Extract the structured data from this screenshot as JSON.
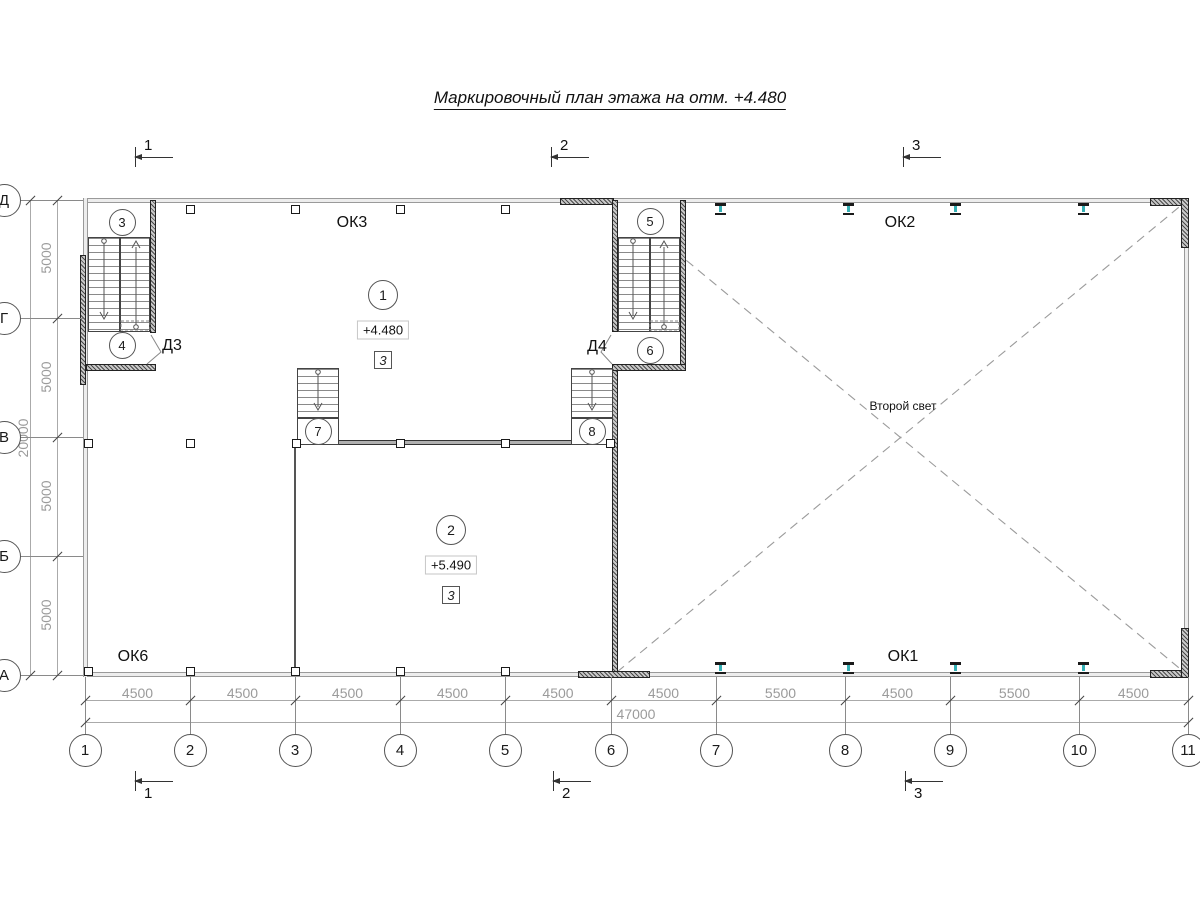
{
  "title": "Маркировочный план этажа на отм. +4.480",
  "void_label": "Второй свет",
  "section_markers": {
    "top": [
      {
        "label": "1",
        "x": 135
      },
      {
        "label": "2",
        "x": 551
      },
      {
        "label": "3",
        "x": 903
      }
    ],
    "bottom": [
      {
        "label": "1",
        "x": 135
      },
      {
        "label": "2",
        "x": 553
      },
      {
        "label": "3",
        "x": 905
      }
    ]
  },
  "axes": {
    "bottom": [
      {
        "label": "1",
        "x": 85
      },
      {
        "label": "2",
        "x": 190
      },
      {
        "label": "3",
        "x": 295
      },
      {
        "label": "4",
        "x": 400
      },
      {
        "label": "5",
        "x": 505
      },
      {
        "label": "6",
        "x": 611
      },
      {
        "label": "7",
        "x": 716
      },
      {
        "label": "8",
        "x": 845
      },
      {
        "label": "9",
        "x": 950
      },
      {
        "label": "10",
        "x": 1079
      },
      {
        "label": "11",
        "x": 1188
      }
    ],
    "left": [
      {
        "label": "Д",
        "y": 200
      },
      {
        "label": "Г",
        "y": 318
      },
      {
        "label": "В",
        "y": 437
      },
      {
        "label": "Б",
        "y": 556
      },
      {
        "label": "А",
        "y": 675
      }
    ]
  },
  "dimensions": {
    "bottom_segments": [
      "4500",
      "4500",
      "4500",
      "4500",
      "4500",
      "4500",
      "5500",
      "4500",
      "5500",
      "4500"
    ],
    "bottom_total": "47000",
    "left_segments": [
      "5000",
      "5000",
      "5000",
      "5000"
    ],
    "left_total": "20000"
  },
  "marks": {
    "windows": [
      {
        "label": "ОК3",
        "x": 352,
        "y": 223
      },
      {
        "label": "ОК2",
        "x": 900,
        "y": 223
      },
      {
        "label": "ОК6",
        "x": 133,
        "y": 657
      },
      {
        "label": "ОК1",
        "x": 903,
        "y": 657
      }
    ],
    "doors": [
      {
        "label": "Д3",
        "x": 172,
        "y": 346
      },
      {
        "label": "Д4",
        "x": 597,
        "y": 347
      }
    ],
    "stairs": [
      {
        "label": "3",
        "x": 122,
        "y": 222
      },
      {
        "label": "4",
        "x": 122,
        "y": 345
      },
      {
        "label": "5",
        "x": 650,
        "y": 221
      },
      {
        "label": "6",
        "x": 650,
        "y": 350
      },
      {
        "label": "7",
        "x": 318,
        "y": 431
      },
      {
        "label": "8",
        "x": 592,
        "y": 431
      }
    ]
  },
  "rooms": [
    {
      "number": "1",
      "elevation": "+4.480",
      "type_mark": "3",
      "cx": 383,
      "cy": 295
    },
    {
      "number": "2",
      "elevation": "+5.490",
      "type_mark": "3",
      "cx": 451,
      "cy": 530
    }
  ],
  "colors": {
    "beam_teal": "#35b0b5",
    "dim_text": "#9b9b9b"
  }
}
